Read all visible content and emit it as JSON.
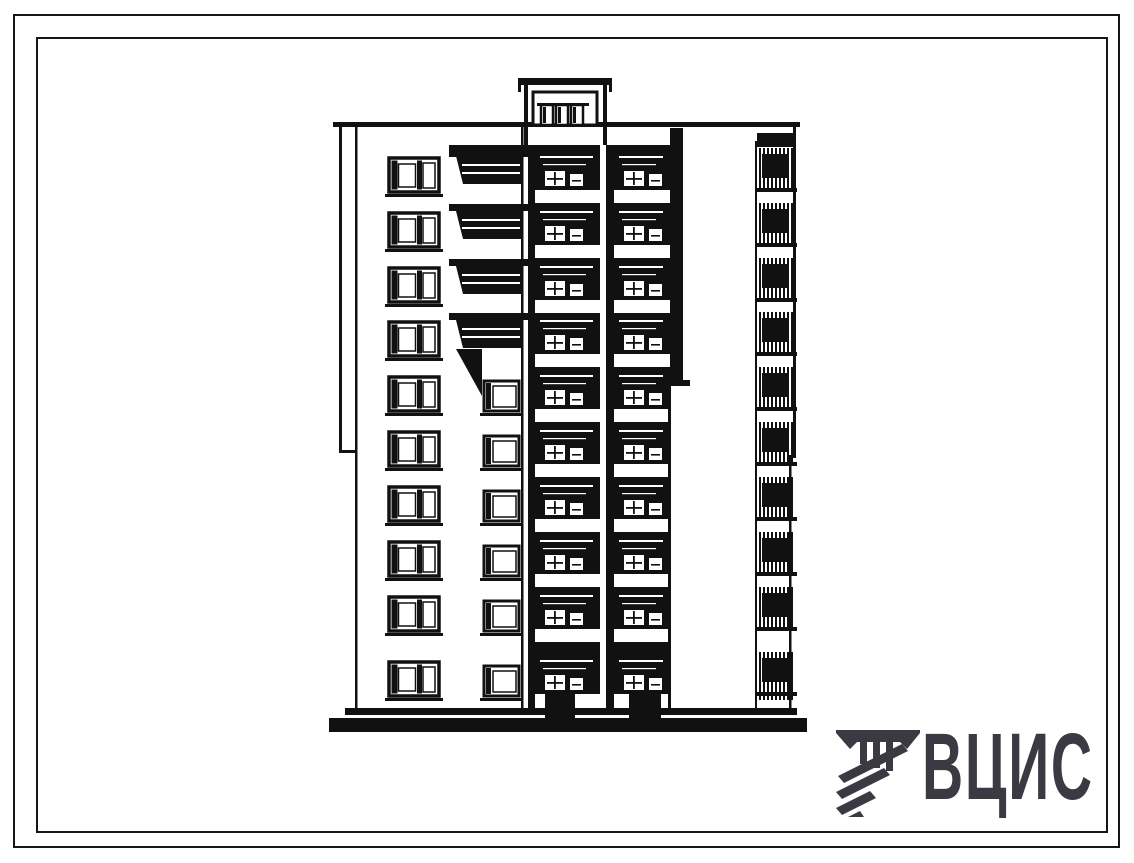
{
  "sheet": {
    "background": "#ffffff",
    "frame_color": "#161616",
    "description": "building-elevation-drawing"
  },
  "logo": {
    "text": "ВЦИС",
    "color": "#3a3a42",
    "icon_name": "hatched-columns-emblem"
  },
  "drawing": {
    "ink": "#111111",
    "floors": 10,
    "rows": [
      158,
      213,
      268,
      322,
      377,
      432,
      487,
      542,
      597,
      662
    ],
    "parapet": {
      "x": 333,
      "y": 122,
      "w": 467,
      "h": 5
    },
    "pilaster": {
      "x": 339,
      "y1": 122,
      "y2": 453,
      "foot_y": 450,
      "foot_w": 18
    },
    "wall_edge_x": 355,
    "wing_wall_right_x": 521,
    "wing_window": {
      "x": 389,
      "w": 50,
      "h": 34,
      "sill_x": 385,
      "sill_w": 58
    },
    "single_window": {
      "x": 484,
      "w": 35,
      "h": 30,
      "first_row": 4,
      "dy": 4
    },
    "balcony": {
      "x": 449,
      "w": 80,
      "rows": 4,
      "rail_h": 28
    },
    "transition_triangle": [
      [
        456,
        349
      ],
      [
        482,
        396
      ],
      [
        482,
        349
      ]
    ],
    "cornice": {
      "x": 449,
      "y": 145,
      "w": 233,
      "h": 12
    },
    "stacks": {
      "colA": {
        "x": 528,
        "w": 72,
        "inner_x": 535,
        "inner_w": 65
      },
      "slit": {
        "x": 600,
        "w": 6
      },
      "colB": {
        "x": 606,
        "w": 64,
        "inner_x": 614,
        "inner_w": 56
      },
      "top": 145,
      "bottom": 712,
      "band_dy": 32,
      "band_h": 13,
      "legA": {
        "x": 545,
        "w": 30
      },
      "legB": {
        "x": 629,
        "w": 32
      }
    },
    "tall_bar": {
      "x": 670,
      "w": 13,
      "y1": 128,
      "y2": 386
    },
    "penthouse": {
      "cap": {
        "x": 518,
        "y": 78,
        "w": 94,
        "h": 7
      },
      "body": {
        "x": 533,
        "y": 92,
        "w": 64,
        "h": 33
      },
      "lintel": {
        "x": 537,
        "y": 103,
        "w": 52,
        "h": 3
      },
      "windows_x": [
        541,
        556,
        571
      ],
      "win": {
        "y": 105,
        "w": 12,
        "h": 20
      },
      "posts": [
        [
          524,
          4
        ],
        [
          603,
          4
        ]
      ],
      "post_y1": 78,
      "post_y2": 146
    },
    "loggia": {
      "left_line_x": 755,
      "stripe_x0": 759,
      "stripe_step": 4,
      "stripe_n": 9,
      "stripe_w": 2,
      "block": {
        "x": 762,
        "w": 25,
        "h": 24
      },
      "slab": {
        "x": 755,
        "w": 42,
        "h": 4
      },
      "top_block": {
        "x": 757,
        "y": 133,
        "w": 38,
        "h": 14
      },
      "right_upper": {
        "x": 793,
        "w": 3,
        "y1": 127,
        "y2": 455
      },
      "step": {
        "x": 789,
        "y": 455,
        "w": 7,
        "h": 3
      },
      "right_lower": {
        "x": 789,
        "w": 2.5,
        "y1": 455,
        "y2": 712
      }
    },
    "base": {
      "x": 345,
      "y": 708,
      "w": 452,
      "h": 7
    },
    "ground": {
      "x": 329,
      "y": 718,
      "w": 478,
      "h": 14
    }
  }
}
